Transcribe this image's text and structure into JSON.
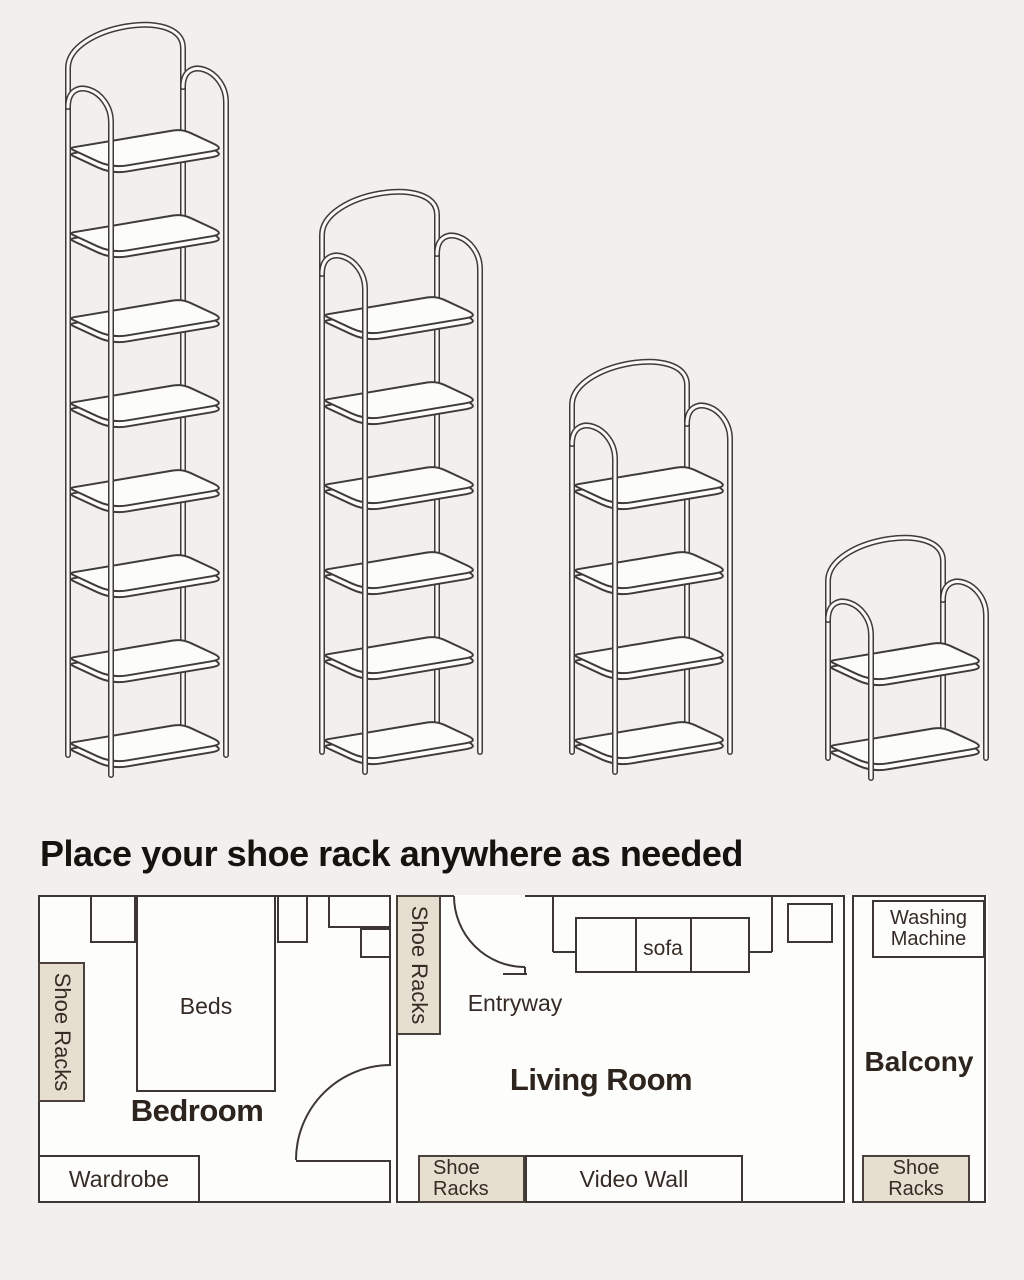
{
  "page": {
    "background": "#f1f0ee",
    "line_color": "#3c3733"
  },
  "heading": "Place your shoe rack anywhere as needed",
  "racks": {
    "line_color": "#3f3b38",
    "items": [
      {
        "name": "rack-8-tier",
        "tiers": 8
      },
      {
        "name": "rack-6-tier",
        "tiers": 6
      },
      {
        "name": "rack-4-tier",
        "tiers": 4
      },
      {
        "name": "rack-2-tier",
        "tiers": 2
      }
    ]
  },
  "floor_plan": {
    "colors": {
      "wall": "#3c3733",
      "shoe_rack_fill": "#e6decf",
      "room_fill": "#fdfdfc"
    },
    "bedroom": {
      "label": "Bedroom",
      "beds": "Beds",
      "wardrobe": "Wardrobe",
      "shoe_racks_vertical": "Shoe Racks"
    },
    "living_room": {
      "label": "Living Room",
      "entryway": "Entryway",
      "sofa": "sofa",
      "shoe_racks_vertical": "Shoe Racks",
      "shoe_racks_line1": "Shoe",
      "shoe_racks_line2": "Racks",
      "video_wall": "Video Wall"
    },
    "balcony": {
      "label": "Balcony",
      "washing_line1": "Washing",
      "washing_line2": "Machine",
      "shoe_racks_line1": "Shoe",
      "shoe_racks_line2": "Racks"
    }
  }
}
